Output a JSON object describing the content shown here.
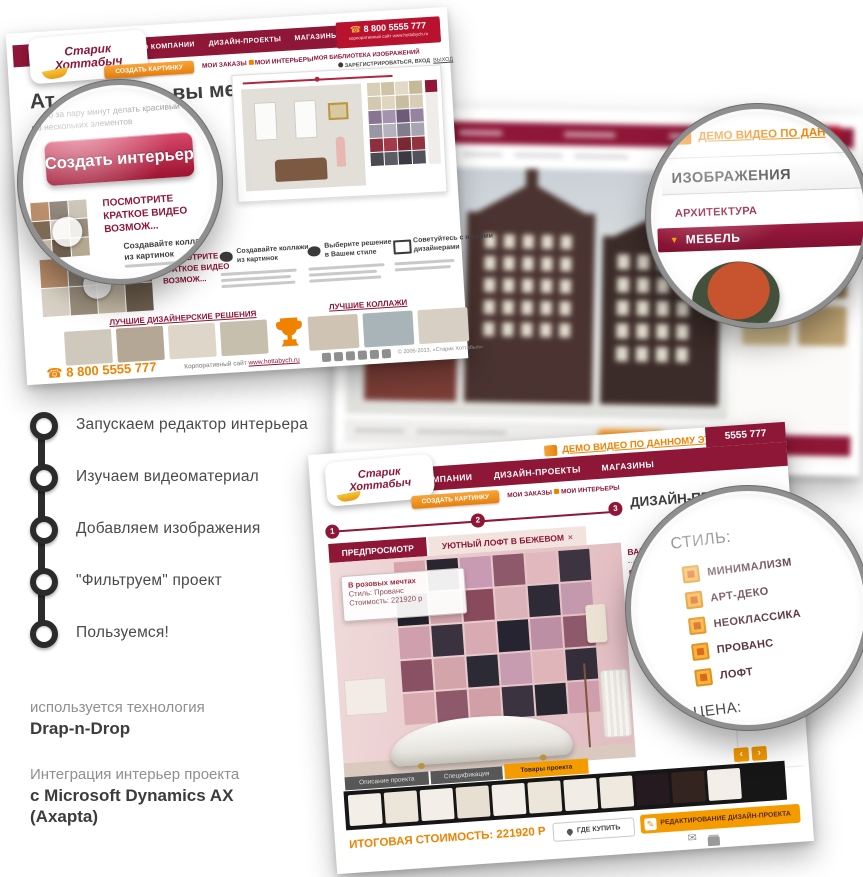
{
  "colors": {
    "maroon": "#8e1637",
    "maroon_dark": "#7a0f2e",
    "orange": "#f08200",
    "orange_btn": "#f49b00",
    "red_button_top": "#d7486a",
    "red_button_bottom": "#9e1331",
    "strip_dark": "#161616"
  },
  "icons": {
    "phone": "☎",
    "envelope": "✉",
    "pencil": "✎",
    "triangle_down": "▼",
    "prev": "‹",
    "next": "›"
  },
  "steps": {
    "items": [
      "Запускаем редактор интерьера",
      "Изучаем видеоматериал",
      "Добавляем изображения",
      "\"Фильтруем\" проект",
      "Пользуемся!"
    ]
  },
  "notes": {
    "tech_label": "используется технология",
    "tech_value": "Drap-n-Drop",
    "integration_label": "Интеграция интерьер проекта",
    "integration_value1": "с Microsoft Dynamics AX",
    "integration_value2": "(Axapta)"
  },
  "brand": {
    "line1": "Старик",
    "line2": "Хоттабыч"
  },
  "win1": {
    "menu": [
      "О КОМПАНИИ",
      "ДИЗАЙН-ПРОЕКТЫ",
      "МАГАЗИНЫ",
      "КОНТАКТЫ"
    ],
    "phone": "8 800 5555 777",
    "phone_sub": "корпоративный сайт www.hottabych.ru",
    "create_btn": "СОЗДАТЬ КАРТИНКУ",
    "links": [
      "МОИ ЗАКАЗЫ",
      "МОИ ИНТЕРЬЕРЫ",
      "МОЯ БИБЛИОТЕКА ИЗОБРАЖЕНИЙ"
    ],
    "auth": "ЗАРЕГИСТРИРОВАТЬСЯ, ВХОД",
    "logout": "ВЫХОД",
    "headline_a": "Ат",
    "headline_b": "ром вы мечт",
    "lead1": "Простое и удобное приложение позволяет",
    "lead2": "всего за пару минут делать красивый интерьер",
    "lead3": "из нескольких элементов",
    "video1": "ПОСМОТРИТЕ",
    "video2": "КРАТКОЕ ВИДЕО",
    "video3": "ВОЗМОЖ...",
    "f1a": "Создавайте коллажи",
    "f1b": "из картинок",
    "f2a": "Выберите решение",
    "f2b": "в Вашем стиле",
    "f3a": "Советуйтесь с нашими",
    "f3b": "дизайнерами",
    "g1": "ЛУЧШИЕ ДИЗАЙНЕРСКИЕ РЕШЕНИЯ",
    "g2": "ЛУЧШИЕ КОЛЛАЖИ",
    "footer_phone": "8 800 5555 777",
    "footer_site_label": "Корпоративный сайт",
    "footer_site_url": "www.hottabych.ru",
    "copyright": "© 2005-2013, «Старик Хоттабыч»"
  },
  "mag1": {
    "button": "Создать интерьер"
  },
  "mag2": {
    "link": "ДЕМО ВИДЕО ПО ДАН",
    "title": "ИЗОБРАЖЕНИЯ",
    "item1": "АРХИТЕКТУРА",
    "item2": "МЕБЕЛЬ"
  },
  "win3": {
    "demo_link": "ДЕМО ВИДЕО ПО ДАННОМУ ЭТАПУ",
    "phone": "5555 777",
    "menu": [
      "О КОМПАНИИ",
      "ДИЗАЙН-ПРОЕКТЫ",
      "МАГАЗИНЫ"
    ],
    "create_btn": "СОЗДАТЬ КАРТИНКУ",
    "links": [
      "МОИ ЗАКАЗЫ",
      "МОИ ИНТЕРЬЕРЫ"
    ],
    "step1": "1",
    "step2": "2",
    "step3": "3",
    "heading": "ДИЗАЙН-ПР",
    "tab_preview": "ПРЕДПРОСМОТР",
    "tab_project": "УЮТНЫЙ ЛОФТ В БЕЖЕВОМ",
    "tab_close": "×",
    "tip1": "В розовых мечтах",
    "tip2": "Стиль: Прованс",
    "tip3": "Стоимость: 221920 р",
    "cats": [
      "ВАННЫЕ КО",
      "ГОСТИНЫЕ",
      "КУХНИ И СТ",
      "СПАЛЬНИ И"
    ],
    "btabs": [
      "Описание проекта",
      "Спецификация",
      "Товары проекта"
    ],
    "total": "ИТОГОВАЯ СТОИМОСТЬ: 221920 Р",
    "where_btn": "ГДЕ КУПИТЬ",
    "edit_btn": "РЕДАКТИРОВАНИЕ ДИЗАЙН-ПРОЕКТА",
    "price_label": "ЦЕНА:"
  },
  "mag3": {
    "close": "×",
    "title": "СТИЛЬ:",
    "options": [
      "МИНИМАЛИЗМ",
      "АРТ-ДЕКО",
      "НЕОКЛАССИКА",
      "ПРОВАНС",
      "ЛОФТ"
    ],
    "price_label": "ЦЕНА:"
  },
  "grids": {
    "palette": {
      "cols": 4,
      "cell": 13,
      "gap": 1,
      "colors": [
        "#d9cfb8",
        "#cfc3a6",
        "#e2d9c6",
        "#c6b998",
        "#d4c9b0",
        "#e0d6c0",
        "#c9bda0",
        "#d8cdb6",
        "#8a7590",
        "#a493ae",
        "#6e5a79",
        "#95839f",
        "#9a97a4",
        "#b5b2bd",
        "#807d8c",
        "#a8a5b2",
        "#8e2f3e",
        "#a43a4a",
        "#7a2836",
        "#93333f",
        "#4a4a52",
        "#5d5d66",
        "#3a3a42",
        "#52525c"
      ]
    },
    "collage": {
      "cols": 4,
      "cell": 27,
      "cellh": 28,
      "gap": 1,
      "colors": [
        "#b98d6a",
        "#8e8378",
        "#c9c2b4",
        "#7d6a55",
        "#d9d2c4",
        "#9a8d7c",
        "#c4b8a4",
        "#6e5f4e"
      ]
    },
    "mag1_collage": {
      "cols": 3,
      "cell": 18,
      "gap": 1,
      "colors": [
        "#b98d6a",
        "#8e8378",
        "#c9c2b4",
        "#7d6a55",
        "#d9d2c4",
        "#9a8d7c",
        "#c4b8a4",
        "#6e5f4e",
        "#b5a890"
      ]
    },
    "g1_thumbs": {
      "cols": 4,
      "cell": 47,
      "cellh": 34,
      "gap": 5,
      "radius": 2,
      "colors": [
        "#cfc8bd",
        "#b5a795",
        "#ded6c9",
        "#c7bfae"
      ]
    },
    "g2_thumbs": {
      "cols": 3,
      "cell": 50,
      "cellh": 34,
      "gap": 5,
      "radius": 2,
      "colors": [
        "#cfc4b4",
        "#a9b4b8",
        "#d8cfc4"
      ]
    },
    "social": {
      "cols": 6,
      "cell": 9,
      "gap": 3,
      "radius": 2,
      "count": 6,
      "color": "#8f8f8f"
    },
    "win2_sidebar": {
      "cols": 2,
      "cell": 48,
      "cellh": 40,
      "gap": 8,
      "radius": 3,
      "colors": [
        "#d9c69b",
        "#c3a878",
        "#e2d3b2",
        "#b09060",
        "#cdb98e",
        "#8f744e",
        "#d5c08f",
        "#bfa474"
      ]
    },
    "house1_windows": {
      "cols": 4,
      "cell": 10,
      "cellh": 13,
      "gap": 7,
      "count": 16,
      "color": "#e6e1d4"
    },
    "house2_windows": {
      "cols": 5,
      "cell": 11,
      "cellh": 14,
      "gap": 8,
      "count": 25,
      "color": "#e2dcce"
    },
    "house3_windows": {
      "cols": 4,
      "cell": 12,
      "cellh": 15,
      "gap": 8,
      "count": 20,
      "color": "#ded8ca"
    },
    "mosaic": {
      "cols": 6,
      "cell": 31,
      "gap": 2,
      "colors": [
        "#d8a3aa",
        "#2a2630",
        "#c99ab3",
        "#8e5a6b",
        "#e0b8bd",
        "#3c3440",
        "#23222c",
        "#d0a2a8",
        "#8a4a5e",
        "#dcb3b8",
        "#2e2b36",
        "#c498ad",
        "#cf9fae",
        "#3a323e",
        "#d8abb2",
        "#262430",
        "#bd8fa4",
        "#8e5a6b",
        "#8a5064",
        "#d3a5ab",
        "#2c2a34",
        "#c79bb0",
        "#dfb5ba",
        "#332e3a",
        "#d9aab0",
        "#8e5a6b",
        "#d0a0a6",
        "#3b333f",
        "#28262e",
        "#cf9dab"
      ]
    },
    "products": {
      "cols": 11,
      "cell": 33,
      "cellh": 31,
      "gap": 3,
      "radius": 2,
      "colors": [
        "#f3efe8",
        "#ece5da",
        "#f3efe8",
        "#e7dfd2",
        "#f3efe8",
        "#ece5da",
        "#f1ede6",
        "#efe9e0",
        "#241a20",
        "#332420",
        "#f3efe8"
      ]
    }
  }
}
